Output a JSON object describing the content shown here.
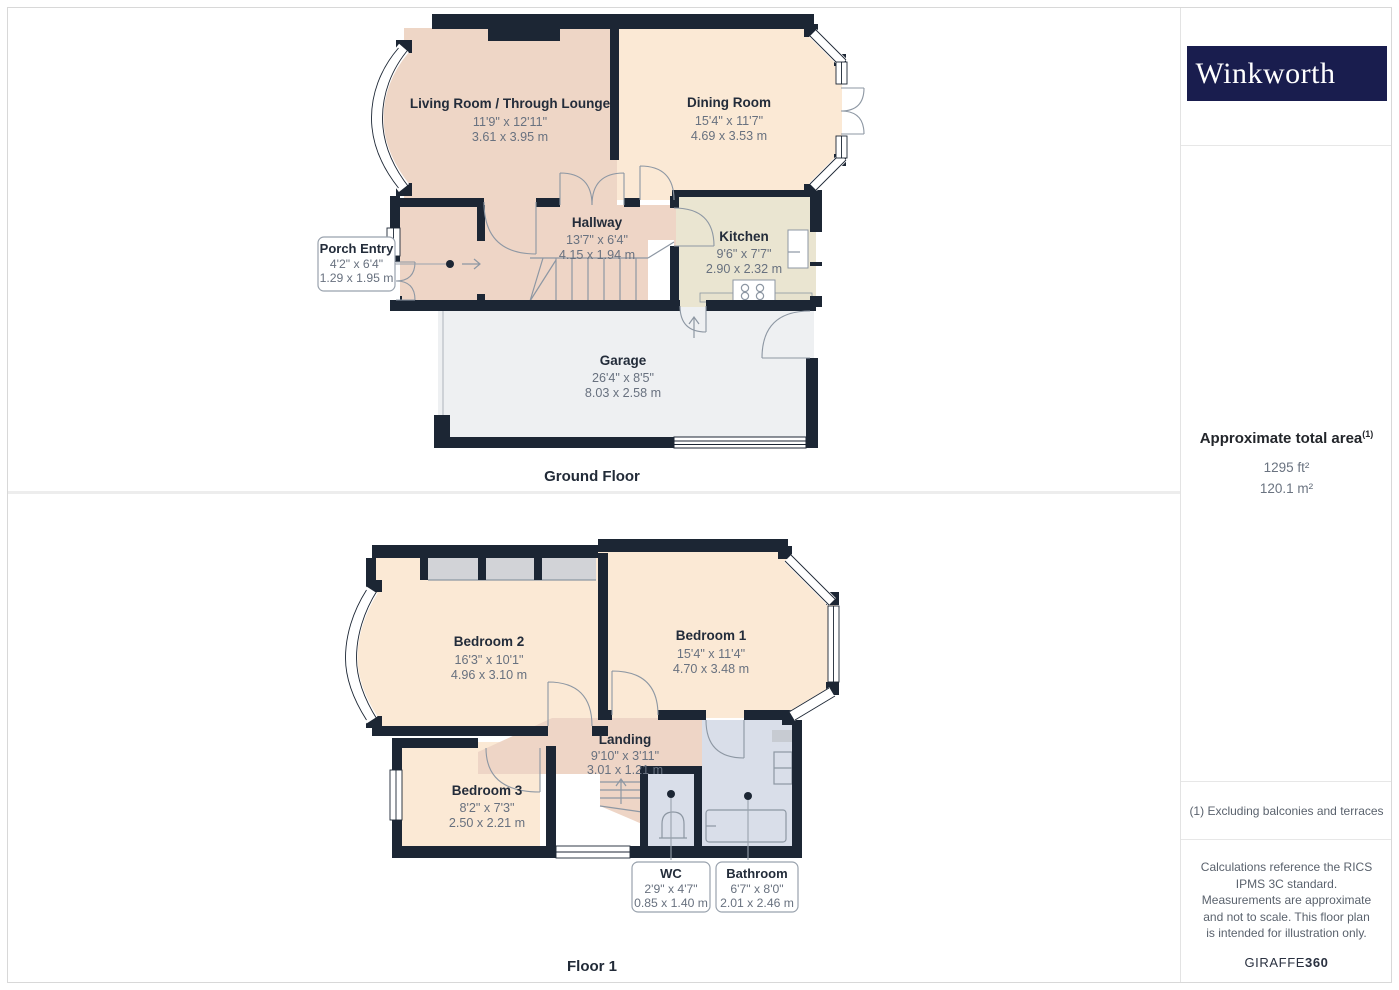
{
  "sidebar": {
    "logo_text": "Winkworth",
    "area": {
      "title": "Approximate total area",
      "superscript": "(1)",
      "imperial": "1295 ft²",
      "metric": "120.1 m²"
    },
    "footnote": "(1) Excluding balconies and terraces",
    "disclaimer": "Calculations reference the RICS IPMS 3C standard. Measurements are approximate and not to scale. This floor plan is intended for illustration only.",
    "credit": {
      "brand": "GIRAFFE",
      "suffix": "360"
    }
  },
  "floors": {
    "ground": {
      "label": "Ground Floor",
      "rooms": {
        "living": {
          "name": "Living Room / Through Lounge",
          "imperial": "11'9\" x 12'11\"",
          "metric": "3.61 x 3.95 m"
        },
        "dining": {
          "name": "Dining Room",
          "imperial": "15'4\" x 11'7\"",
          "metric": "4.69 x 3.53 m"
        },
        "hallway": {
          "name": "Hallway",
          "imperial": "13'7\" x 6'4\"",
          "metric": "4.15 x 1.94 m"
        },
        "kitchen": {
          "name": "Kitchen",
          "imperial": "9'6\" x 7'7\"",
          "metric": "2.90 x 2.32 m"
        },
        "porch": {
          "name": "Porch Entry",
          "imperial": "4'2\" x 6'4\"",
          "metric": "1.29 x 1.95 m"
        },
        "garage": {
          "name": "Garage",
          "imperial": "26'4\" x 8'5\"",
          "metric": "8.03 x 2.58 m"
        }
      }
    },
    "first": {
      "label": "Floor 1",
      "rooms": {
        "bedroom2": {
          "name": "Bedroom 2",
          "imperial": "16'3\" x 10'1\"",
          "metric": "4.96 x 3.10 m"
        },
        "bedroom1": {
          "name": "Bedroom 1",
          "imperial": "15'4\" x 11'4\"",
          "metric": "4.70 x 3.48 m"
        },
        "bedroom3": {
          "name": "Bedroom 3",
          "imperial": "8'2\" x 7'3\"",
          "metric": "2.50 x 2.21 m"
        },
        "landing": {
          "name": "Landing",
          "imperial": "9'10\" x 3'11\"",
          "metric": "3.01 x 1.21 m"
        },
        "wc": {
          "name": "WC",
          "imperial": "2'9\" x 4'7\"",
          "metric": "0.85 x 1.40 m"
        },
        "bathroom": {
          "name": "Bathroom",
          "imperial": "6'7\" x 8'0\"",
          "metric": "2.01 x 2.46 m"
        }
      }
    }
  },
  "colors": {
    "wall": "#1c2634",
    "room_pink": "#eed5c6",
    "room_peach": "#fbe9d5",
    "kitchen_beige": "#eae5d1",
    "garage_gray": "#eef0f2",
    "bath_blue": "#d9dee9",
    "closet_gray": "#d2d3d7",
    "logo_navy": "#191d4e"
  }
}
